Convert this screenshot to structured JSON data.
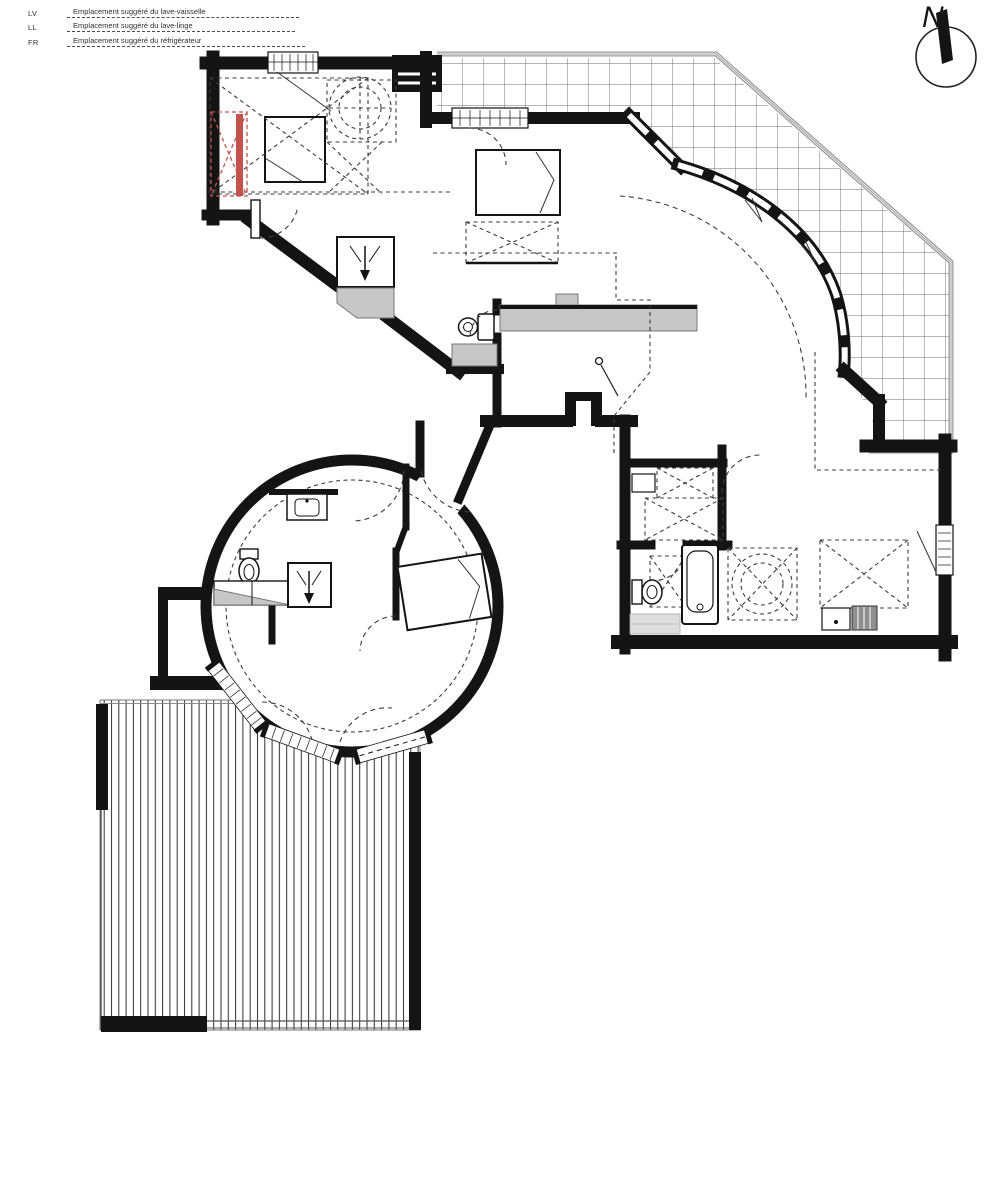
{
  "legend": {
    "items": [
      {
        "abbr": "LV",
        "label": "Emplacement suggéré du lave-vaisselle"
      },
      {
        "abbr": "LL",
        "label": "Emplacement suggéré du lave-linge"
      },
      {
        "abbr": "FR",
        "label": "Emplacement suggéré du réfrigérateur"
      }
    ]
  },
  "north": {
    "label": "N"
  },
  "colors": {
    "wall": "#141414",
    "hatch_line": "#6b6b6b",
    "deck_line": "#2e2e2e",
    "counter_gray": "#c7c7c7",
    "light_gray": "#dedede",
    "dash_gray": "#3c3c3c",
    "railing_gray": "#9a9a9a",
    "highlight_red": "#c4534e",
    "background": "#ffffff"
  }
}
